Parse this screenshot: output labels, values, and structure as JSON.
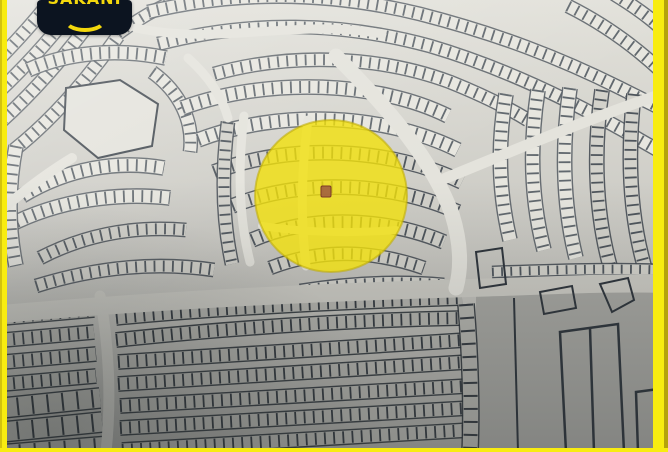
{
  "logo": {
    "partial_text": "SAKANI",
    "bg_color": "#0c1420",
    "accent_color": "#f4d80c"
  },
  "map": {
    "base_light": "#e2e1da",
    "base_mid": "#c9c8c2",
    "base_dark": "#a6a6a1",
    "parcel_fill_light": "#e7e6df",
    "parcel_fill_mid": "#d3d2cb",
    "parcel_fill_low": "#b3b3ad",
    "parcel_line_light": "#5a6167",
    "parcel_line_mid": "#474e55",
    "parcel_line_dark": "#2d343a",
    "road_light": "#e4e3dc",
    "road_lower": "#cbcac3",
    "vacant_area_fill": "#a6a6a1",
    "plot_outline_color": "#2e353c"
  },
  "highlight": {
    "shape": "circle",
    "cx": 331,
    "cy": 196,
    "r": 76,
    "fill": "#f2e10b",
    "opacity": 0.8,
    "ring": "#c0ae09"
  },
  "marker": {
    "x": 321,
    "y": 186,
    "w": 10,
    "h": 11,
    "fill": "#a2603f",
    "stroke": "#7d3b26"
  },
  "frame": {
    "fill": "#f8ec10",
    "edge": "#b5a30b"
  }
}
